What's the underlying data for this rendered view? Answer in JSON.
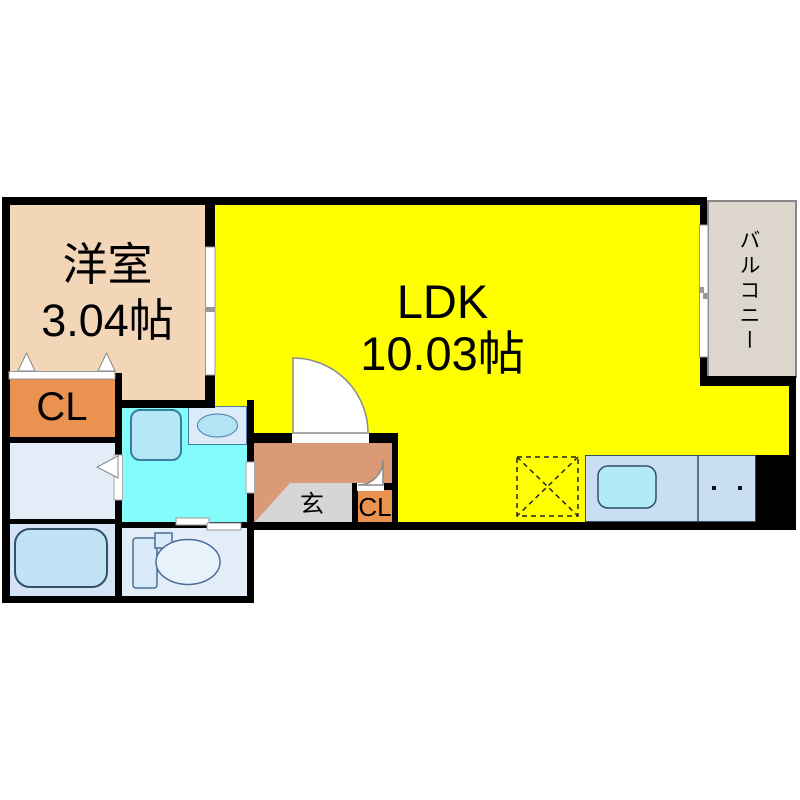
{
  "plan": {
    "type": "apartment-floor-plan",
    "rooms": {
      "western": {
        "name": "洋室",
        "size": "3.04帖"
      },
      "ldk": {
        "name": "LDK",
        "size": "10.03帖"
      },
      "closet_main": {
        "label": "CL"
      },
      "closet_entry": {
        "label": "CL"
      },
      "entrance": {
        "label": "玄"
      },
      "balcony": {
        "label": "バルコニー"
      }
    },
    "colors": {
      "ldk_floor": "#ffff00",
      "western_floor": "#f3d6b8",
      "closet_floor": "#ea9351",
      "hall_floor": "#d99a75",
      "entrance_step": "#d6d6d6",
      "balcony_floor": "#ddd6cd",
      "sanitary_floor": "#85fcfc",
      "washroom_floor": "#e3edf8",
      "bath_floor": "#d4e4f4",
      "fixture_blue": "#b5e8f7",
      "wall": "#000000"
    }
  }
}
